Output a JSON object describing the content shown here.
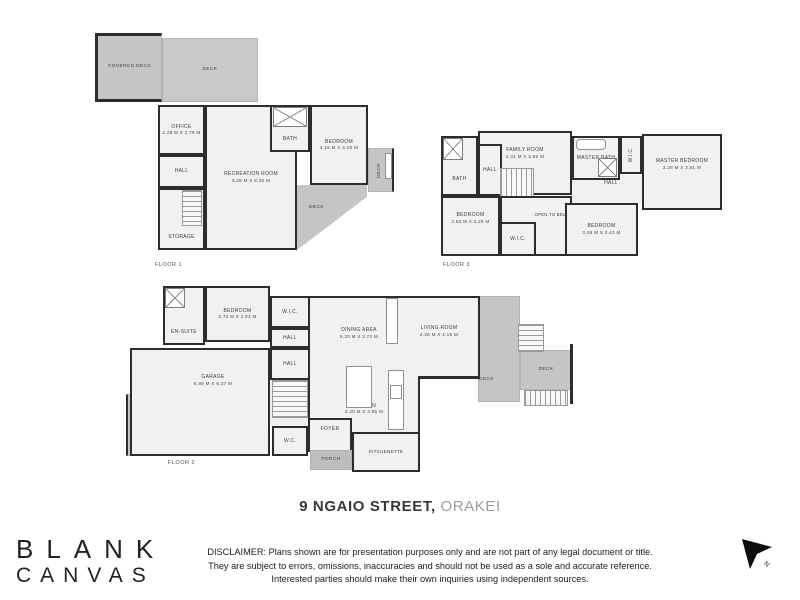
{
  "title": {
    "address": "9 NGAIO STREET,",
    "suburb": "ORAKEI"
  },
  "logo": {
    "line1": "BLANK",
    "line2": "CANVAS"
  },
  "disclaimer": {
    "line1": "DISCLAIMER: Plans shown are for presentation purposes only and are not part of any legal document or title.",
    "line2": "They are subject to errors, omissions, inaccuracies and should not be used as a sole and accurate reference.",
    "line3": "Interested parties should make their own inquiries using independent sources."
  },
  "north": {
    "label": "N"
  },
  "colors": {
    "wall": "#2d2d2d",
    "floor": "#f1f1f1",
    "deck": "#c5c5c5",
    "title_dark": "#383838",
    "title_light": "#9c9c9c"
  },
  "floors": [
    {
      "label": "FLOOR 1",
      "rooms": [
        {
          "name": "COVERED DECK"
        },
        {
          "name": "DECK"
        },
        {
          "name": "OFFICE",
          "dims": "2.28 M X 2.78 M"
        },
        {
          "name": "HALL"
        },
        {
          "name": "STORAGE"
        },
        {
          "name": "RECREATION ROOM",
          "dims": "3.28 M X 8.35 M"
        },
        {
          "name": "BATH"
        },
        {
          "name": "BEDROOM",
          "dims": "4.16 M X 4.19 M"
        },
        {
          "name": "DECK"
        },
        {
          "name": "DECK"
        }
      ]
    },
    {
      "label": "FLOOR 2",
      "rooms": [
        {
          "name": "EN-SUITE"
        },
        {
          "name": "BEDROOM",
          "dims": "3.73 M X 2.93 M"
        },
        {
          "name": "W.I.C."
        },
        {
          "name": "HALL"
        },
        {
          "name": "DINING AREA",
          "dims": "5.30 M X 3.72 M"
        },
        {
          "name": "LIVING ROOM",
          "dims": "4.26 M X 4.19 M"
        },
        {
          "name": "GARAGE",
          "dims": "5.99 M X 6.37 M"
        },
        {
          "name": "HALL"
        },
        {
          "name": "KITCHEN",
          "dims": "3.20 M X 3.85 M"
        },
        {
          "name": "FOYER"
        },
        {
          "name": "W.C."
        },
        {
          "name": "PORCH"
        },
        {
          "name": "KITCHENETTE"
        },
        {
          "name": "DECK"
        },
        {
          "name": "DECK"
        },
        {
          "name": "DECK"
        }
      ]
    },
    {
      "label": "FLOOR 3",
      "rooms": [
        {
          "name": "BATH"
        },
        {
          "name": "HALL"
        },
        {
          "name": "FAMILY ROOM",
          "dims": "4.31 M X 3.59 M"
        },
        {
          "name": "MASTER BATH"
        },
        {
          "name": "W.I.C."
        },
        {
          "name": "MASTER BEDROOM",
          "dims": "3.38 M X 3.61 M"
        },
        {
          "name": "HALL"
        },
        {
          "name": "BEDROOM",
          "dims": "2.63 M X 3.26 M"
        },
        {
          "name": "W.I.C."
        },
        {
          "name": "OPEN TO BELOW"
        },
        {
          "name": "BEDROOM",
          "dims": "3.08 M X 3.42 M"
        }
      ]
    }
  ]
}
